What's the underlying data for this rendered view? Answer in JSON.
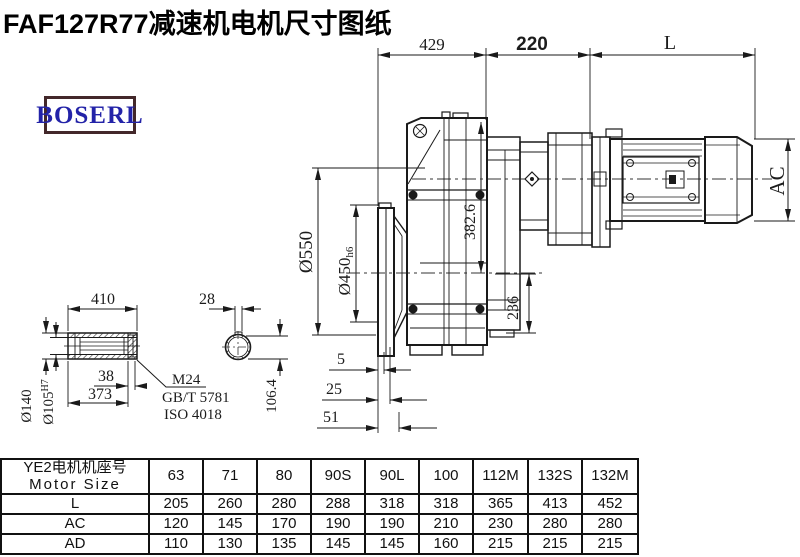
{
  "title": "FAF127R77减速机电机尺寸图纸",
  "logo": {
    "text": "BOSERL"
  },
  "colors": {
    "line": "#1a1a1a",
    "logo_border": "#43282a",
    "logo_text": "#2323a8"
  },
  "dims": {
    "d429": "429",
    "d220": "220",
    "dL": "L",
    "dAC": "AC",
    "d550": "Ø550",
    "d450": "Ø450",
    "d450tol": "h6",
    "d382": "382.6",
    "d236": "236",
    "d410": "410",
    "d28": "28",
    "d140": "Ø140",
    "d105": "Ø105",
    "d105tol": "H7",
    "d38": "38",
    "d373": "373",
    "m24": "M24",
    "gb": "GB/T 5781",
    "iso": "ISO 4018",
    "d106": "106.4",
    "d5": "5",
    "d25": "25",
    "d51": "51"
  },
  "table": {
    "header_cn": "YE2电机机座号",
    "header_en": "Motor Size",
    "sizes": [
      "63",
      "71",
      "80",
      "90S",
      "90L",
      "100",
      "112M",
      "132S",
      "132M"
    ],
    "rows": [
      {
        "label": "L",
        "values": [
          "205",
          "260",
          "280",
          "288",
          "318",
          "318",
          "365",
          "413",
          "452"
        ]
      },
      {
        "label": "AC",
        "values": [
          "120",
          "145",
          "170",
          "190",
          "190",
          "210",
          "230",
          "280",
          "280"
        ]
      },
      {
        "label": "AD",
        "values": [
          "110",
          "130",
          "135",
          "145",
          "145",
          "160",
          "215",
          "215",
          "215"
        ]
      }
    ]
  }
}
